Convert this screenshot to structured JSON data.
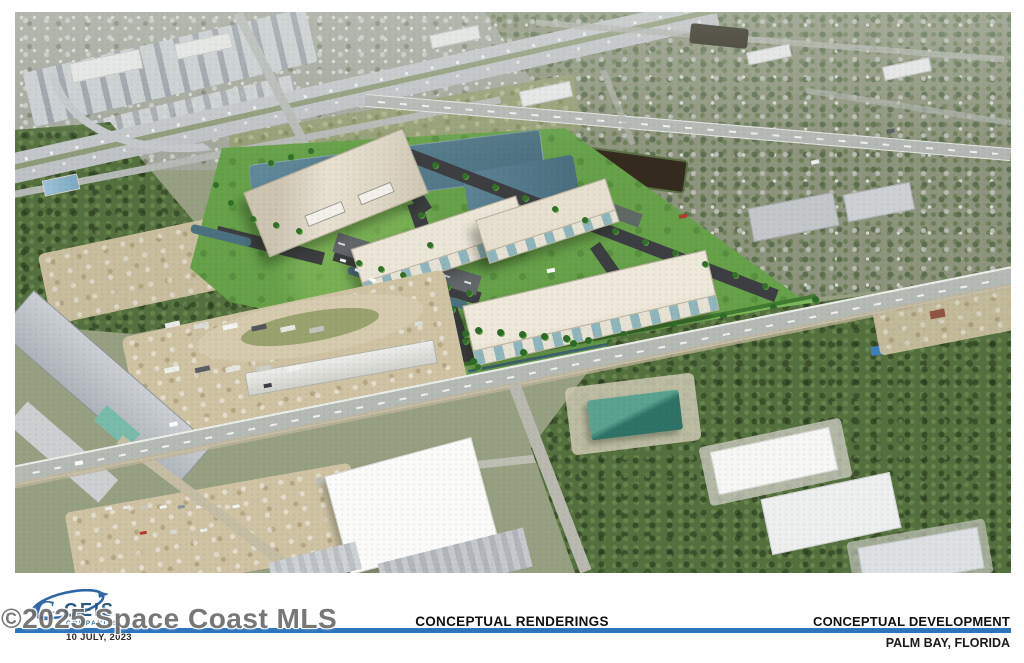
{
  "footer": {
    "center_title": "CONCEPTUAL RENDERINGS",
    "right_title": "CONCEPTUAL DEVELOPMENT",
    "right_subtitle": "PALM BAY, FLORIDA",
    "logo_name": "GEIS",
    "logo_subtext": "COMPANIES",
    "date": "10 JULY, 2023"
  },
  "watermark": {
    "text": "©2025 Space Coast MLS"
  },
  "colors": {
    "divider_blue": "#2e74bc",
    "logo_blue": "#2f66a7",
    "watermark_gray": "#6d6d6d",
    "site_green": "#67a14a",
    "pond_blue": "#56808f",
    "building_beige": "#e6dfcf",
    "new_asphalt": "#3c3e41",
    "road_gray": "#b5b9b3"
  }
}
